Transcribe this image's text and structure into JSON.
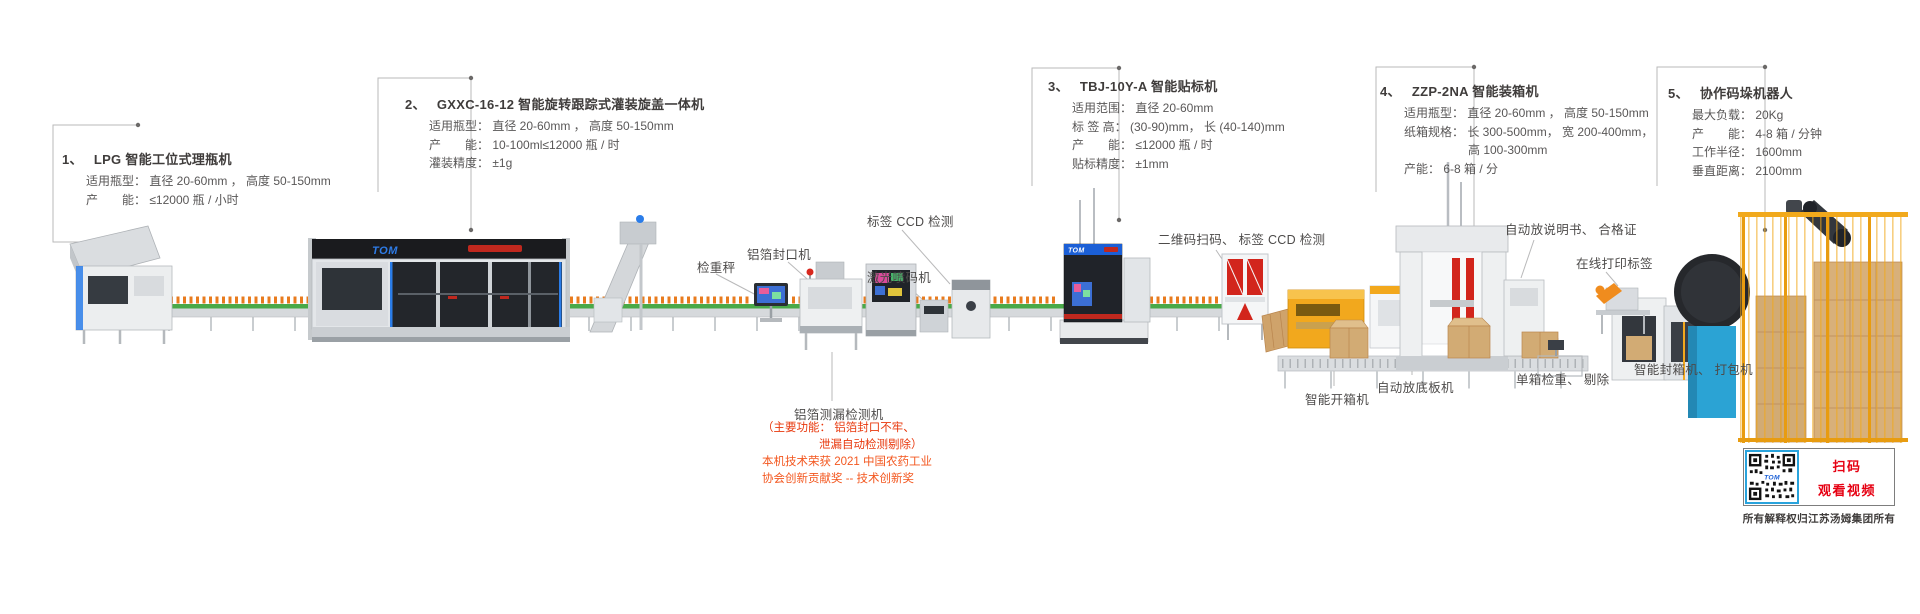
{
  "brand": "TOM",
  "callouts": [
    {
      "num": "1、",
      "title": "LPG 智能工位式理瓶机",
      "lines": [
        "适用瓶型： 直径 20-60mm ， 高度 50-150mm",
        "产　　能： ≤12000 瓶 / 小时"
      ]
    },
    {
      "num": "2、",
      "title": "GXXC-16-12 智能旋转跟踪式灌装旋盖一体机",
      "lines": [
        "适用瓶型： 直径 20-60mm ， 高度 50-150mm",
        "产　　能： 10-100ml≤12000 瓶 / 时",
        "灌装精度： ±1g"
      ]
    },
    {
      "num": "3、",
      "title": "TBJ-10Y-A 智能贴标机",
      "lines": [
        "适用范围： 直径 20-60mm",
        "标 签 高： (30-90)mm， 长 (40-140)mm",
        "产　　能： ≤12000 瓶 / 时",
        "贴标精度： ±1mm"
      ]
    },
    {
      "num": "4、",
      "title": "ZZP-2NA 智能装箱机",
      "lines": [
        "适用瓶型： 直径 20-60mm ， 高度 50-150mm",
        "纸箱规格： 长 300-500mm， 宽 200-400mm，",
        "高 100-300mm",
        "产能： 6-8 箱 / 分"
      ]
    },
    {
      "num": "5、",
      "title": "协作码垛机器人",
      "lines": [
        "最大负载： 20Kg",
        "产　　能： 4-8 箱 / 分钟",
        "工作半径： 1600mm",
        "垂直距离： 2100mm"
      ]
    }
  ],
  "labels": {
    "weigher": "检重秤",
    "foil_sealer": "铝箔封口机",
    "label_ccd": "标签 CCD 检测",
    "laser_coder": "激光喷码机",
    "qr_ccd": "二维码扫码、 标签 CCD 检测",
    "manual_insert": "自动放说明书、 合格证",
    "online_print": "在线打印标签",
    "case_opener": "智能开箱机",
    "bottom_pad": "自动放底板机",
    "box_check": "单箱检重、 剔除",
    "case_sealer": "智能封箱机、 打包机"
  },
  "leak": {
    "title": "铝箔测漏检测机",
    "notes": [
      "（主要功能： 铝箔封口不牢、",
      "泄漏自动检测剔除）",
      "本机技术荣获 2021 中国农药工业",
      "协会创新贡献奖 -- 技术创新奖"
    ]
  },
  "qr": {
    "line1": "扫码",
    "line2": "观看视频",
    "footer": "所有解释权归江苏汤姆集团所有"
  },
  "colors": {
    "label_text": "#4d4b4a",
    "leader_line": "#b9b9ba",
    "note_red": "#e8380d",
    "award_orange": "#f3571f",
    "qr_red": "#e60012",
    "brand_blue": "#2e7ce8",
    "machine_yellow": "#f2a81d",
    "belt_green": "#49a948",
    "kraft_box": "#d2ab74",
    "panel_red": "#d2251c",
    "turntable_blue": "#2ba3d4"
  }
}
